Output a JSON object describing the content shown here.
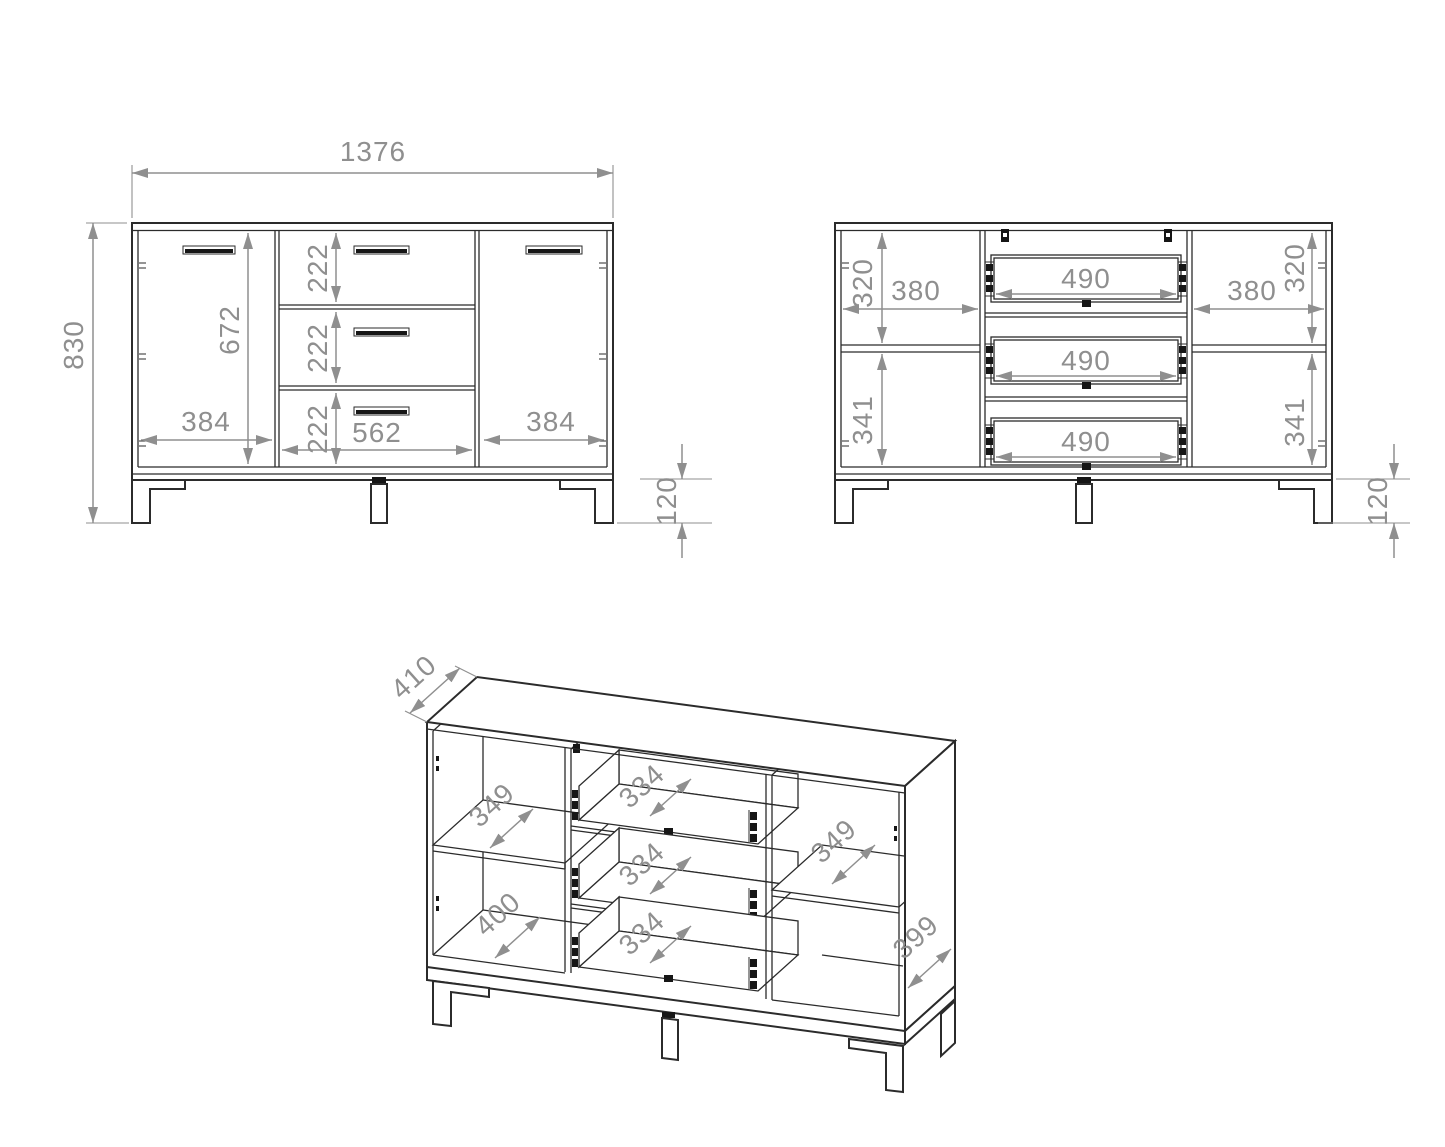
{
  "drawing": {
    "outline_color": "#2b2b2b",
    "dimension_color": "#8f8f8f",
    "background_color": "#ffffff"
  },
  "front_view": {
    "overall_width": "1376",
    "overall_height": "830",
    "door_height": "672",
    "drawer_heights": [
      "222",
      "222",
      "222"
    ],
    "left_door_width": "384",
    "drawer_width": "562",
    "right_door_width": "384",
    "leg_height": "120"
  },
  "internal_view": {
    "left_width": "380",
    "left_top_height": "320",
    "left_bottom_height": "341",
    "drawer_widths": [
      "490",
      "490",
      "490"
    ],
    "right_width": "380",
    "right_top_height": "320",
    "right_bottom_height": "341",
    "leg_height": "120"
  },
  "perspective_view": {
    "top_depth": "410",
    "left_shelf_depth": "349",
    "left_bottom_depth": "400",
    "drawer_depths": [
      "334",
      "334",
      "334"
    ],
    "right_shelf_depth": "349",
    "right_side_depth": "399"
  }
}
